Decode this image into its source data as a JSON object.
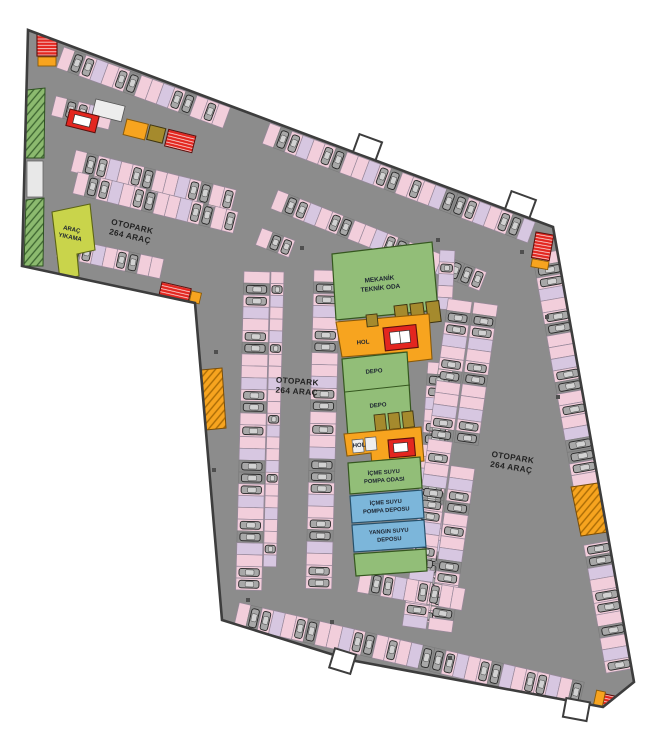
{
  "plan": {
    "type": "parking-garage-floor-plan",
    "labels": {
      "otopark_left": {
        "line1": "OTOPARK",
        "line2": "264 ARAÇ"
      },
      "otopark_center": {
        "line1": "OTOPARK",
        "line2": "264 ARAÇ"
      },
      "otopark_right": {
        "line1": "OTOPARK",
        "line2": "264 ARAÇ"
      }
    },
    "rooms": {
      "mekanik_teknik_oda": {
        "line1": "MEKANİK",
        "line2": "TEKNİK ODA"
      },
      "hol_upper": {
        "label": "HOL"
      },
      "depo_upper": {
        "label": "DEPO"
      },
      "depo_lower": {
        "label": "DEPO"
      },
      "hol_lower": {
        "label": "HOL"
      },
      "icme_suyu_pompa_odasi": {
        "line1": "İÇME SUYU",
        "line2": "POMPA ODASI"
      },
      "icme_suyu_pompa_deposu": {
        "line1": "İÇME SUYU",
        "line2": "POMPA DEPOSU"
      },
      "yangin_suyu_deposu": {
        "line1": "YANGIN SUYU",
        "line2": "DEPOSU"
      },
      "arac_yikama": {
        "line1": "ARAÇ",
        "line2": "YIKAMA"
      }
    },
    "palette": {
      "floor_gray": "#8c8c8c",
      "wall_outline": "#3d3d3d",
      "stall_pink": "#f2cedb",
      "stall_lavender": "#d7c7e1",
      "car_gray": "#a8a8a8",
      "room_green": "#92be78",
      "wash_yellow_green": "#c9d44b",
      "tank_blue": "#7cb6da",
      "hall_orange": "#f7a41f",
      "stair_red": "#e3261f",
      "utility_olive": "#a58a2d"
    }
  }
}
